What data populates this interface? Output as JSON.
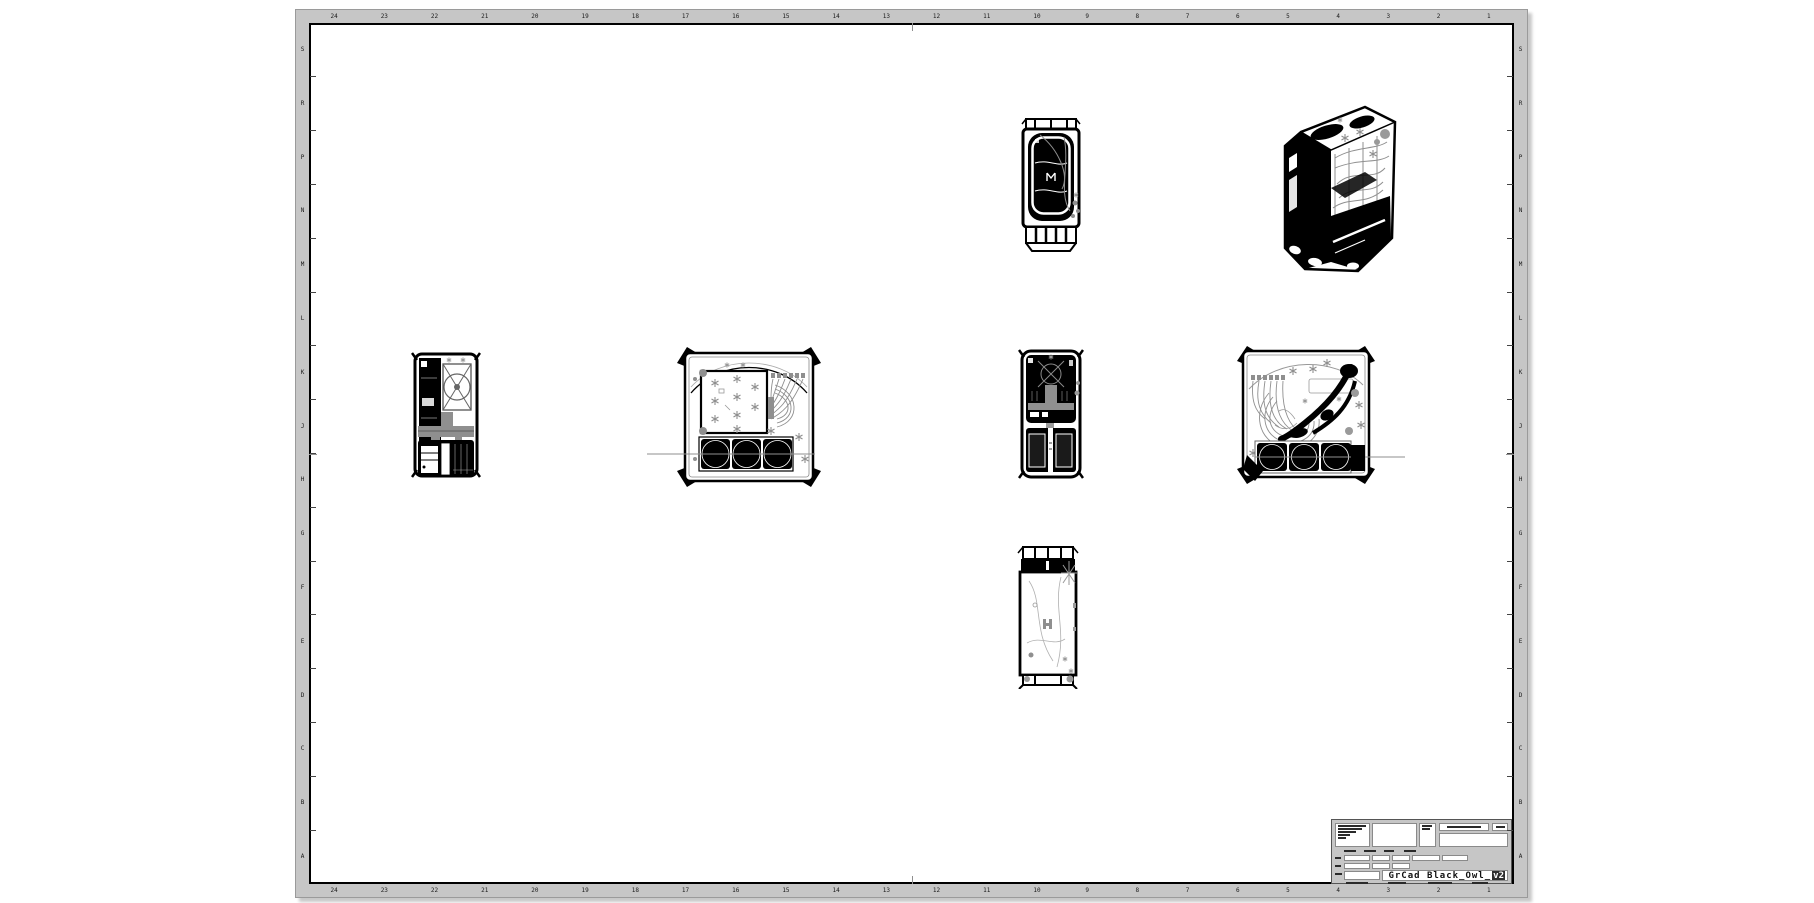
{
  "sheet": {
    "title": "GrCad Black_Owl_",
    "title_suffix": "v2",
    "zone_columns": [
      "24",
      "23",
      "22",
      "21",
      "20",
      "19",
      "18",
      "17",
      "16",
      "15",
      "14",
      "13",
      "12",
      "11",
      "10",
      "9",
      "8",
      "7",
      "6",
      "5",
      "4",
      "3",
      "2",
      "1"
    ],
    "zone_rows": [
      "S",
      "R",
      "P",
      "N",
      "M",
      "L",
      "K",
      "J",
      "H",
      "G",
      "F",
      "E",
      "D",
      "C",
      "B",
      "A"
    ],
    "colors": {
      "band": "#c6c6c6",
      "paper": "#ffffff",
      "ink": "#000000",
      "detail_gray": "#8f8f8f"
    }
  }
}
